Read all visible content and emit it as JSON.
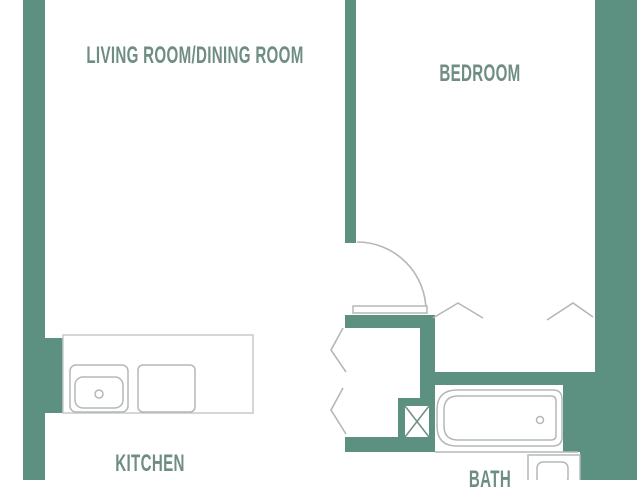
{
  "palette": {
    "bg": "#ffffff",
    "wall": "#5c9181",
    "label": "#6f8d84",
    "line": "#b4b8b5",
    "counter": "#c6cac7",
    "xline": "#6e8f82"
  },
  "rooms": {
    "living": {
      "label": "LIVING ROOM/DINING ROOM"
    },
    "bedroom": {
      "label": "BEDROOM"
    },
    "kitchen": {
      "label": "KITCHEN"
    },
    "bath": {
      "label": "BATH"
    }
  },
  "fixtures": [
    "kitchen-sink",
    "kitchen-range",
    "bathtub",
    "vanity-sink",
    "duct-shaft",
    "bedroom-door-swing",
    "closet-door-chevrons"
  ]
}
